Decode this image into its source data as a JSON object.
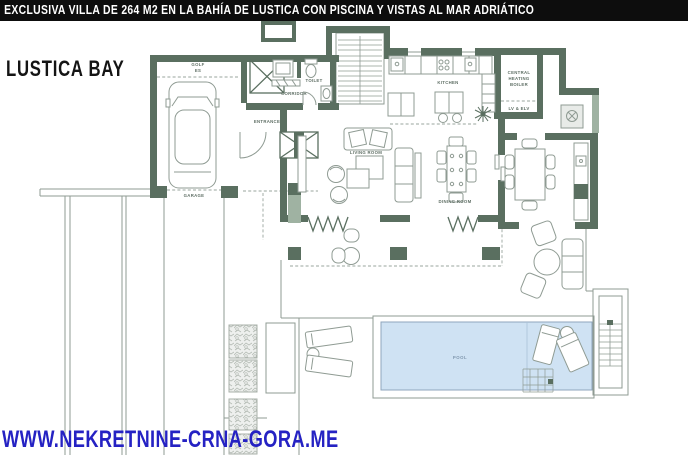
{
  "header": {
    "caption": "EXCLUSIVA VILLA DE 264 M2 EN LA BAHÍA DE LUSTICA CON PISCINA Y VISTAS AL MAR ADRIÁTICO"
  },
  "branding": {
    "location_title": "LUSTICA BAY",
    "website_url": "WWW.NEKRETNINE-CRNA-GORA.ME"
  },
  "floorplan": {
    "rooms": {
      "golf": {
        "line1": "GOLF",
        "line2": "ES"
      },
      "garage": "GARAGE",
      "corridor": "CORRIDOR",
      "toilet": "TOILET",
      "entrance": "ENTRANCE",
      "kitchen": "KITCHEN",
      "boiler": {
        "line1": "CENTRAL",
        "line2": "HEATING",
        "line3": "BOILER"
      },
      "lv_elv": "LV & ELV",
      "living_room": "LIVING ROOM",
      "dining_room": "DINING ROOM",
      "pool": "POOL"
    },
    "colors": {
      "wall_dark": "#5a6f60",
      "wall_light": "#9fb2a2",
      "outline": "#8f9b93",
      "pool_fill": "#cfe2f3",
      "pool_stroke": "#8fa6bd",
      "header_bg": "#0d0d0d",
      "header_text": "#ffffff",
      "title_text": "#141414",
      "website_text": "#2522c3",
      "label_text": "#5f6f65"
    }
  }
}
